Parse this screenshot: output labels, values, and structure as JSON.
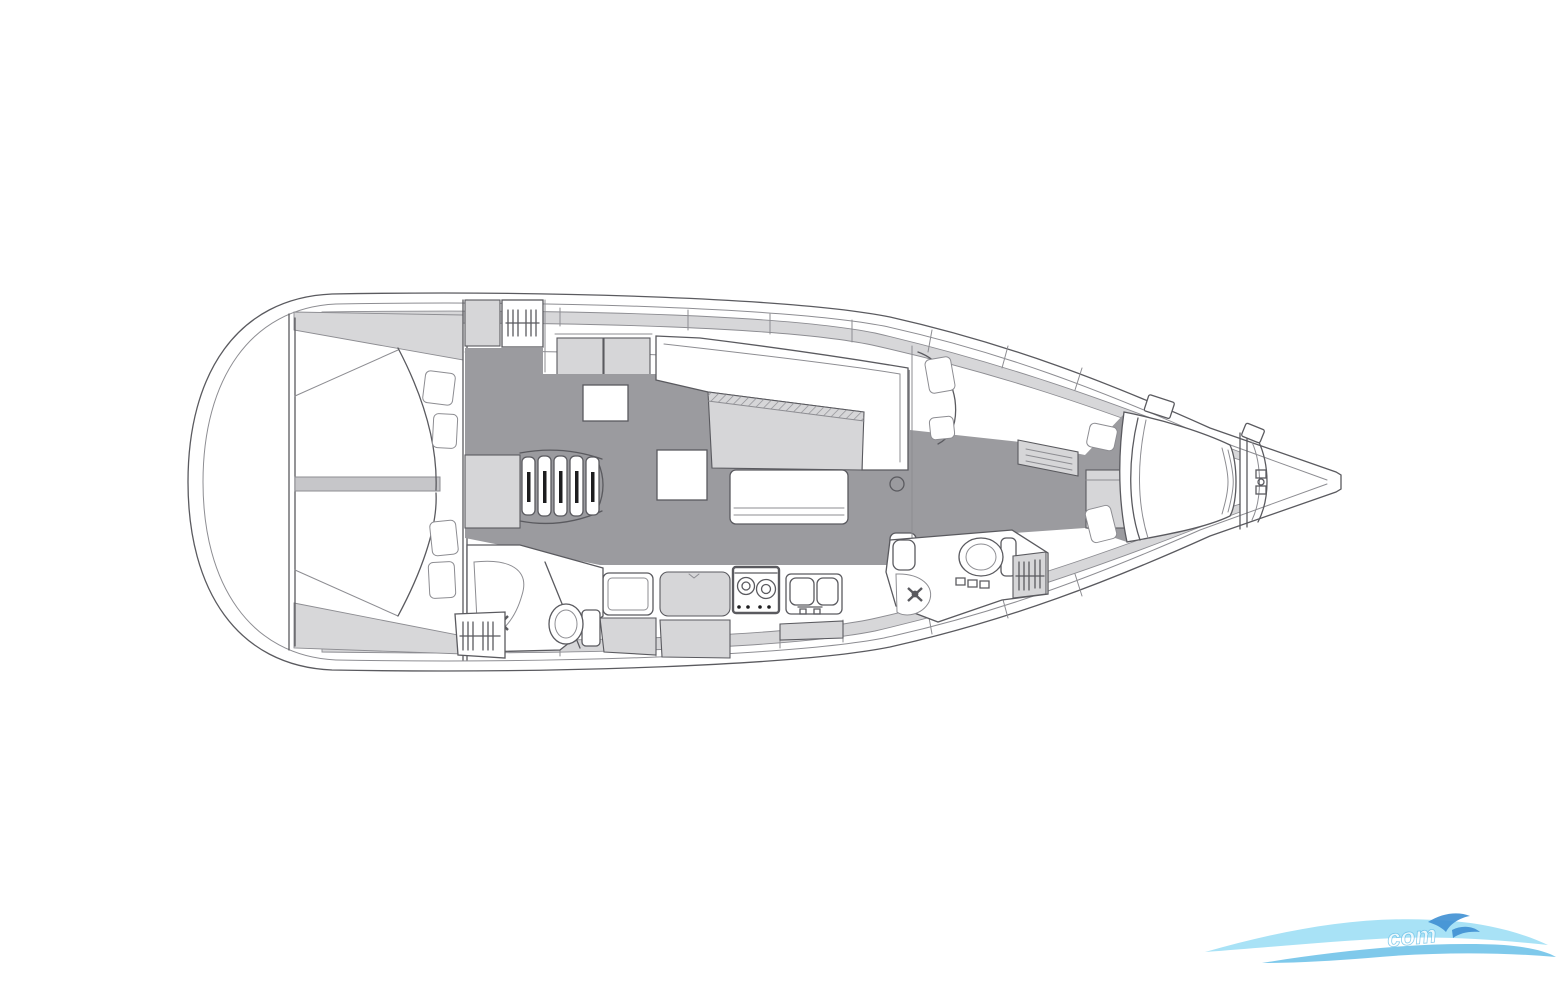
{
  "canvas": {
    "width": 1560,
    "height": 981,
    "background": "#ffffff"
  },
  "colors": {
    "line": "#5a5a5f",
    "line_soft": "#8d8d92",
    "floor": "#9b9b9f",
    "panel": "#d6d6d8",
    "panel_mid": "#c6c6c9",
    "band": "#d7d7d9",
    "white": "#ffffff",
    "slot_dark": "#1d1d1f",
    "logo_light": "#a8e2f6",
    "logo_mid": "#69c0e8",
    "logo_dark": "#3e8fd3"
  },
  "drawing": {
    "type": "sailing-yacht-interior-layout-plan",
    "orientation": "bow-right-stern-left",
    "features": [
      "aft-cabin-two-double-berths",
      "companionway-steps",
      "aft-head-shower-toilet",
      "galley-fridge-worktop-stove-double-sink",
      "salon-settee-and-table",
      "salon-bench",
      "nav-seat-cushions",
      "forward-head-sink-shower-toilet",
      "hanging-locker-shelves",
      "wardrobe",
      "forward-v-berth",
      "anchor-windlass",
      "deck-hatches",
      "vent-grilles"
    ]
  },
  "watermark": {
    "text": "com"
  }
}
